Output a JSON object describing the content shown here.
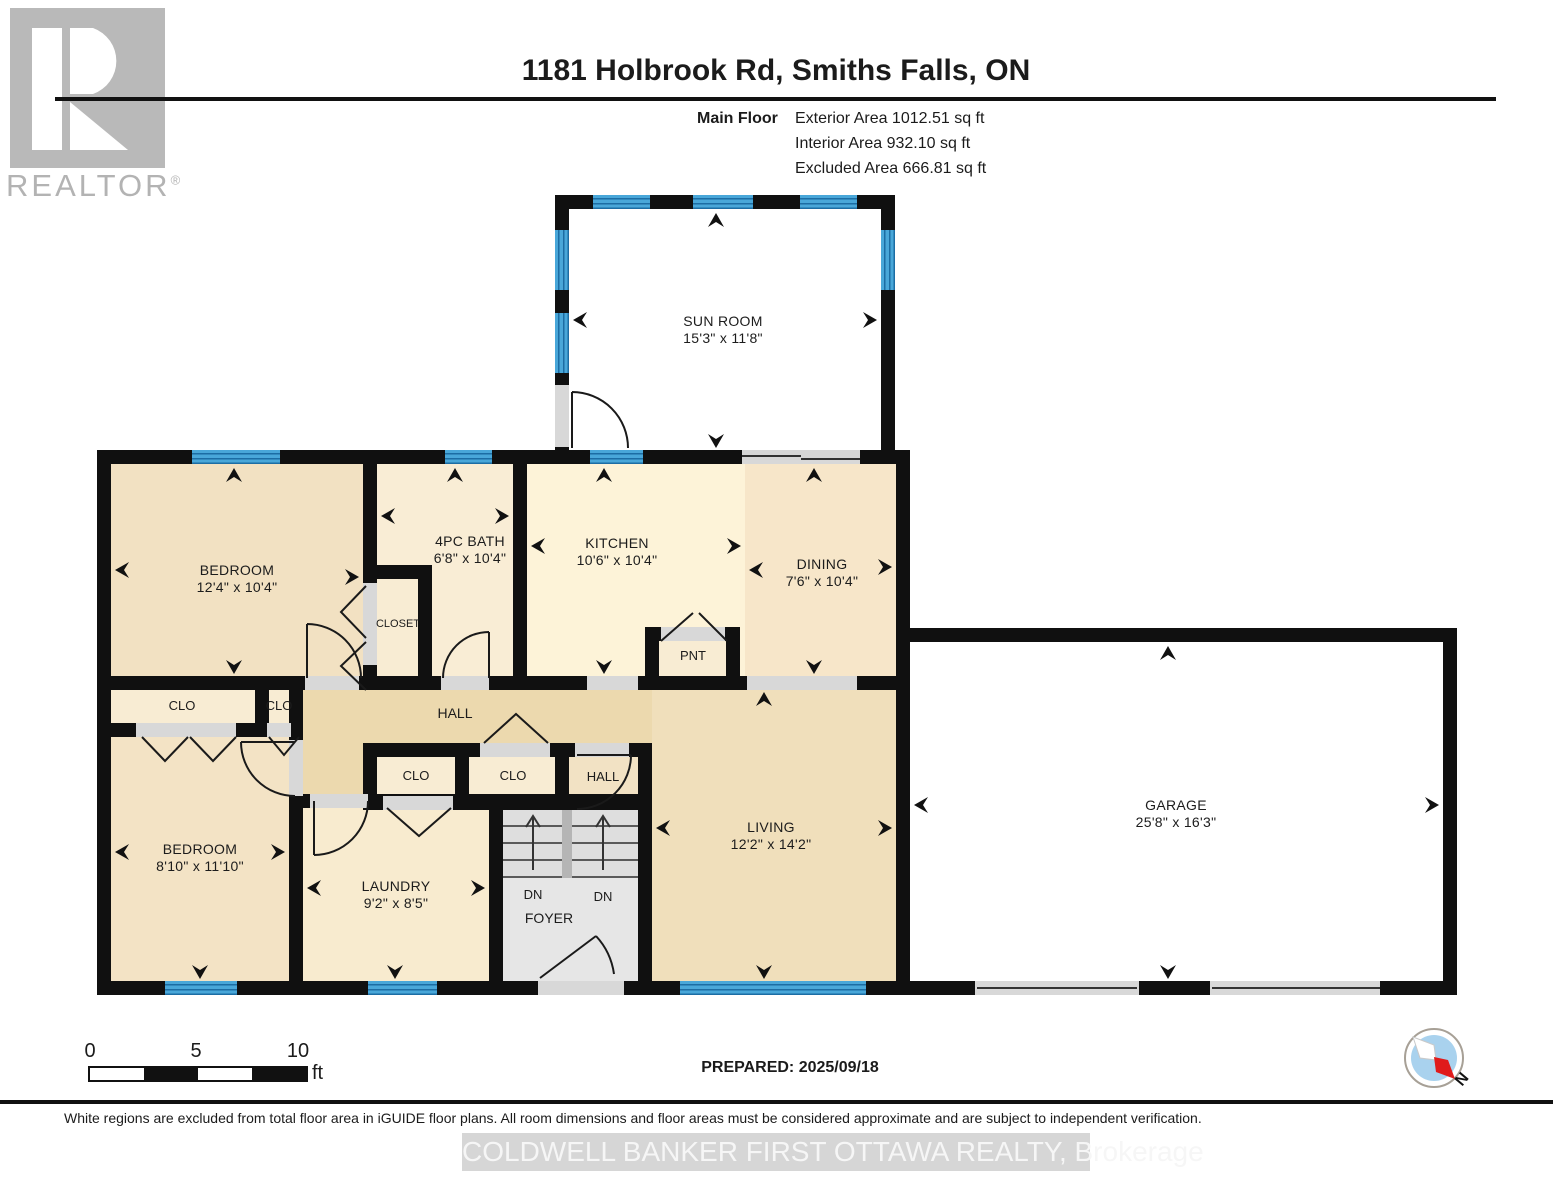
{
  "header": {
    "title": "1181 Holbrook Rd, Smiths Falls, ON",
    "floor_label": "Main Floor",
    "stats": [
      "Exterior Area 1012.51 sq ft",
      "Interior Area 932.10 sq ft",
      "Excluded Area 666.81 sq ft"
    ]
  },
  "logo": {
    "brand": "REALTOR",
    "reg": "®"
  },
  "rooms": [
    {
      "name": "SUN ROOM",
      "dims": "15'3\" x 11'8\""
    },
    {
      "name": "BEDROOM",
      "dims": "12'4\" x 10'4\""
    },
    {
      "name": "4PC BATH",
      "dims": "6'8\" x 10'4\""
    },
    {
      "name": "KITCHEN",
      "dims": "10'6\" x 10'4\""
    },
    {
      "name": "DINING",
      "dims": "7'6\" x 10'4\""
    },
    {
      "name": "LIVING",
      "dims": "12'2\" x 14'2\""
    },
    {
      "name": "BEDROOM",
      "dims": "8'10\" x 11'10\""
    },
    {
      "name": "LAUNDRY",
      "dims": "9'2\" x 8'5\""
    },
    {
      "name": "GARAGE",
      "dims": "25'8\" x 16'3\""
    }
  ],
  "labels": {
    "closet": "CLOSET",
    "clo": "CLO",
    "pantry": "PNT",
    "hall": "HALL",
    "dn": "DN",
    "foyer": "FOYER"
  },
  "scale_bar": {
    "t0": "0",
    "t5": "5",
    "t10": "10",
    "unit": "ft"
  },
  "compass": {
    "north": "N"
  },
  "footer": {
    "prepared": "PREPARED: 2025/09/18",
    "disclaimer": "White regions are excluded from total floor area in iGUIDE floor plans. All room dimensions and floor areas must be considered approximate and are subject to independent verification.",
    "watermark": "COLDWELL BANKER FIRST OTTAWA REALTY, Brokerage"
  }
}
